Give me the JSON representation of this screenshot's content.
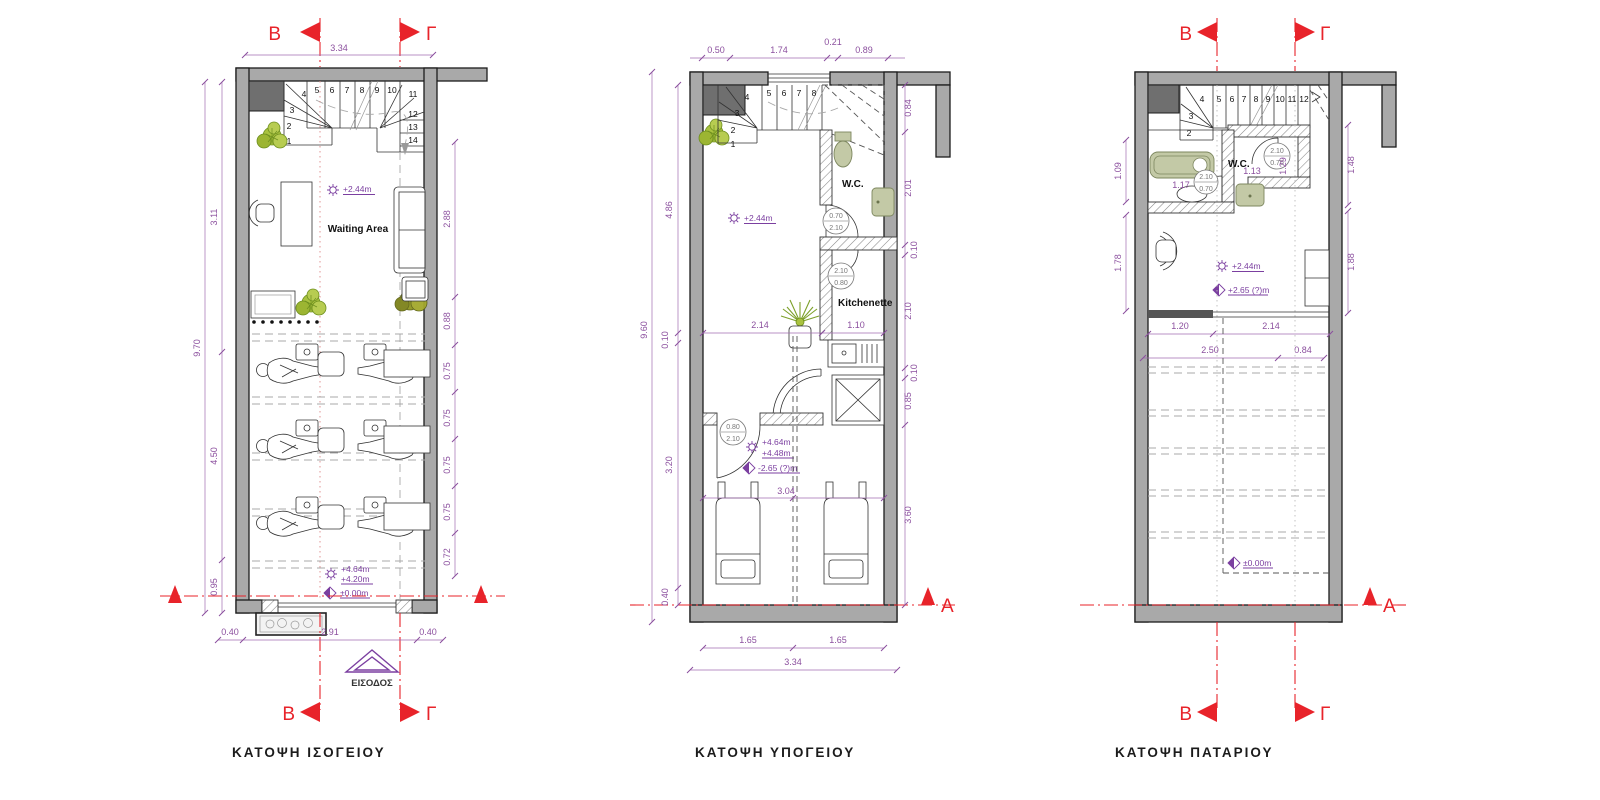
{
  "page": {
    "background": "#ffffff"
  },
  "colors": {
    "section_red": "#e8232a",
    "dimension_purple": "#8b4f9e",
    "level_purple": "#7b3fa0",
    "wall_grey": "#a9a9a9",
    "dark_grey": "#6f6f6f",
    "fixture_green": "#c3c9a6",
    "plant_green": "#a9c23f"
  },
  "plans": {
    "ground": {
      "title": "ΚΑΤΟΨΗ ΙΣΟΓΕΙΟΥ",
      "markers": {
        "b": "B",
        "g": "Γ"
      },
      "labels": {
        "waiting_area": "Waiting Area",
        "entrance": "ΕΙΣΟΔΟΣ"
      },
      "levels": {
        "ceiling": "+2.44m",
        "lvl1": "+4.64m",
        "lvl2": "+4.20m",
        "lvl0": "±0.00m"
      },
      "dims": {
        "top": "3.34",
        "left": [
          "3.11",
          "9.70",
          "4.50",
          "0.95"
        ],
        "right": [
          "2.88",
          "0.88",
          "0.75",
          "0.75",
          "0.75",
          "0.75",
          "0.72"
        ],
        "bottom": [
          "0.40",
          "2.91",
          "0.40"
        ]
      },
      "stair_numbers": [
        "1",
        "2",
        "3",
        "4",
        "5",
        "6",
        "7",
        "8",
        "9",
        "10",
        "11",
        "12",
        "13",
        "14"
      ]
    },
    "basement": {
      "title": "ΚΑΤΟΨΗ ΥΠΟΓΕΙΟΥ",
      "marker_a": "A",
      "labels": {
        "wc": "W.C.",
        "kitchenette": "Kitchenette"
      },
      "levels": {
        "ceiling": "+2.44m",
        "lvl1": "+4.64m",
        "lvl2": "+4.48m",
        "lvl3": "-2.65 (?)m"
      },
      "door_tags": {
        "wc": [
          "0.70",
          "2.10"
        ],
        "kitchenette": [
          "2.10",
          "0.80"
        ],
        "room": [
          "0.80",
          "2.10"
        ]
      },
      "dims": {
        "top": [
          "0.50",
          "1.74",
          "0.21",
          "0.89"
        ],
        "left": [
          "4.86",
          "9.60",
          "0.10",
          "3.20",
          "0.40"
        ],
        "right": [
          "0.84",
          "2.01",
          "0.10",
          "2.10",
          "0.10",
          "0.85",
          "3.60"
        ],
        "inner": [
          "2.14",
          "1.10",
          "3.04"
        ],
        "bottom": [
          "1.65",
          "1.65",
          "3.34"
        ]
      },
      "stair_numbers": [
        "1",
        "2",
        "3",
        "4",
        "5",
        "6",
        "7",
        "8"
      ]
    },
    "loft": {
      "title": "ΚΑΤΟΨΗ ΠΑΤΑΡΙΟΥ",
      "markers": {
        "b": "B",
        "g": "Γ",
        "a": "A"
      },
      "labels": {
        "wc": "W.C."
      },
      "levels": {
        "ceiling": "+2.44m",
        "lvl": "+2.65 (?)m",
        "lvl0": "±0.00m"
      },
      "door_tags": {
        "bath": [
          "2.10",
          "0.70"
        ],
        "wc": [
          "2.10",
          "0.70"
        ]
      },
      "dims": {
        "left": [
          "1.09",
          "1.78"
        ],
        "right": [
          "1.48",
          "1.88"
        ],
        "bath": [
          "1.17",
          "1.13",
          "1.29"
        ],
        "loft_edge": [
          "1.20",
          "2.14",
          "2.50",
          "0.84"
        ]
      },
      "stair_numbers": [
        "2",
        "3",
        "4",
        "5",
        "6",
        "7",
        "8",
        "9",
        "10",
        "11",
        "12"
      ]
    }
  }
}
